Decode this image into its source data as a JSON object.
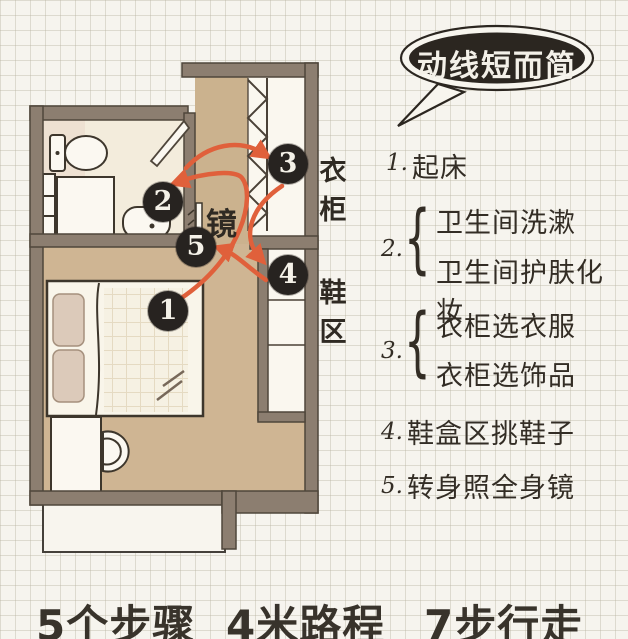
{
  "bubble": {
    "text": "动线短而简"
  },
  "plan": {
    "mirror_label": "镜",
    "wardrobe_label": "衣柜",
    "shoe_area_label": "鞋区",
    "markers": [
      "1",
      "2",
      "3",
      "4",
      "5"
    ]
  },
  "steps": [
    {
      "num": "1.",
      "lines": [
        "起床"
      ]
    },
    {
      "num": "2.",
      "lines": [
        "卫生间洗漱",
        "卫生间护肤化妆"
      ]
    },
    {
      "num": "3.",
      "lines": [
        "衣柜选衣服",
        "衣柜选饰品"
      ]
    },
    {
      "num": "4.",
      "lines": [
        "鞋盒区挑鞋子"
      ]
    },
    {
      "num": "5.",
      "lines": [
        "转身照全身镜"
      ]
    }
  ],
  "footer": {
    "stats": [
      "5个步骤",
      "4米路程",
      "7步行走"
    ]
  },
  "colors": {
    "paper": "#f6f4ee",
    "ink": "#332d25",
    "wall": "#8c7e70",
    "floor_tan": "#cfb593",
    "bathroom_floor": "#f3ecdc",
    "arrow": "#e0603b",
    "marker_bg": "#272320",
    "bubble_bg": "#2b2620",
    "bubble_text": "#f3f0e8"
  }
}
